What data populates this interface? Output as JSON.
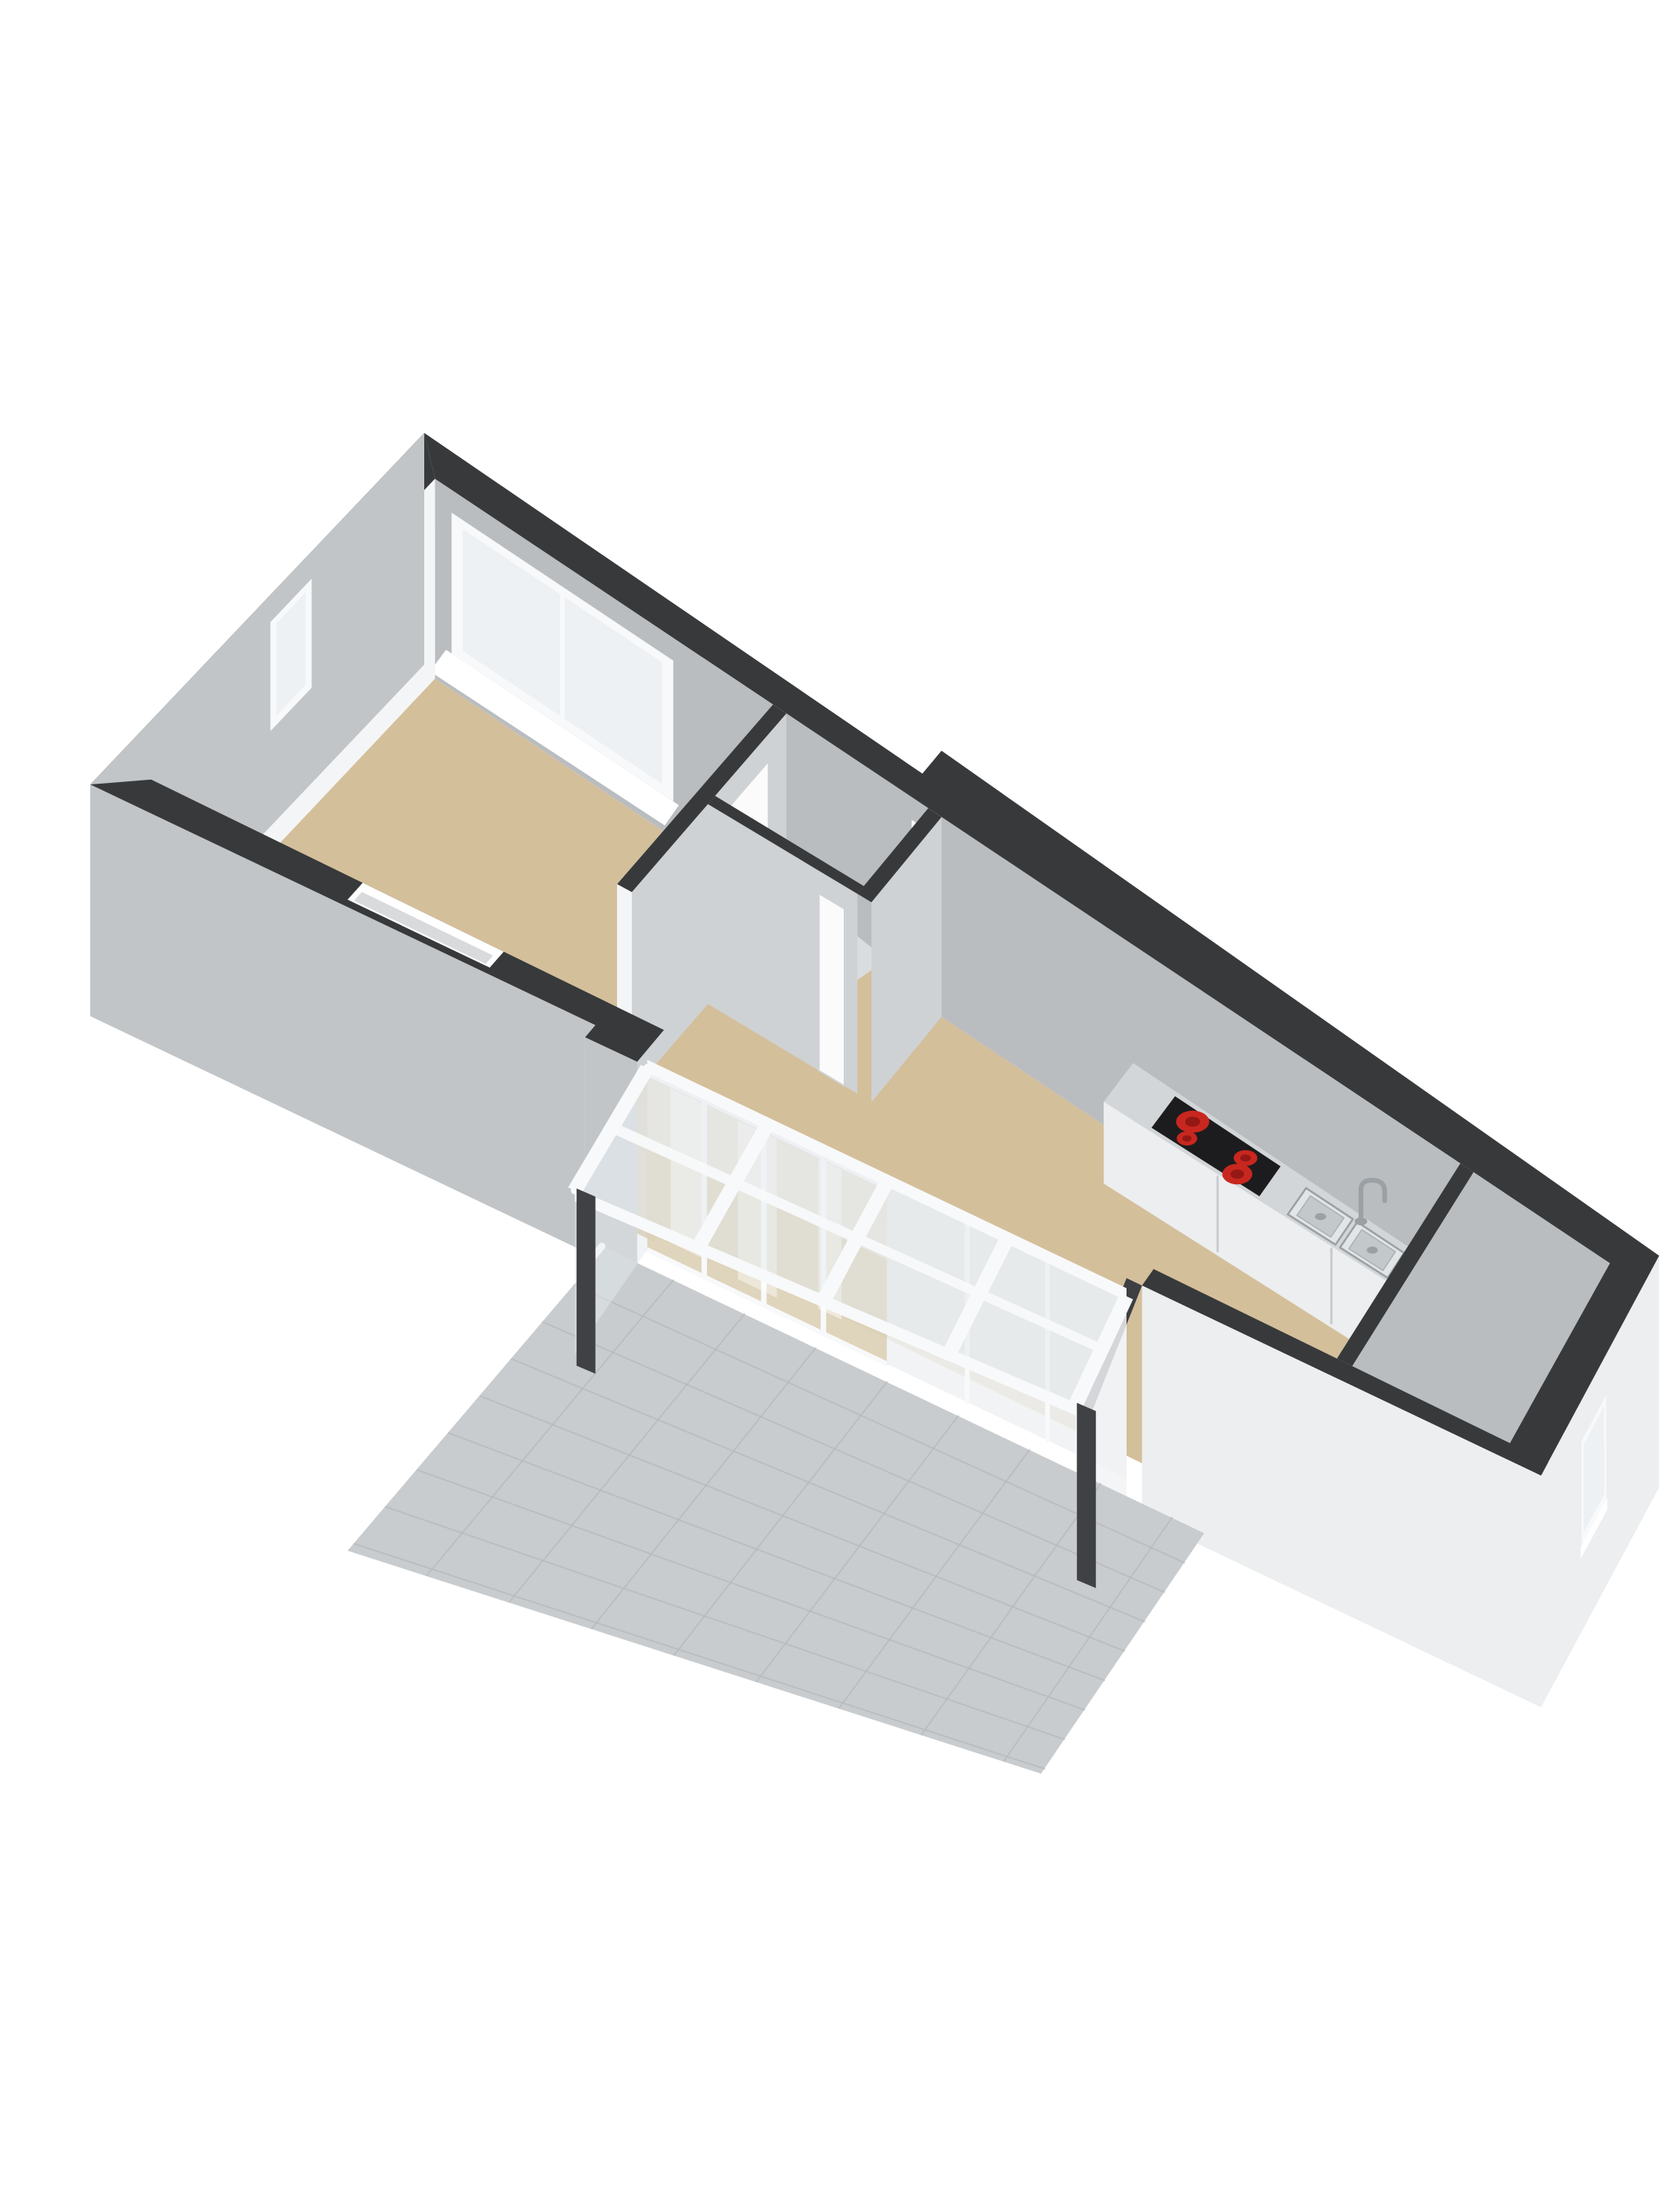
{
  "view": {
    "type": "floorplan-3d-isometric",
    "description": "3D dollhouse-style floor plan of a ground floor apartment, viewed from above at an angle, no text labels",
    "background": "#ffffff"
  },
  "colors": {
    "bg": "#ffffff",
    "wall_top": "#37393b",
    "wall_top_soft": "#3d3f42",
    "ext_gray": "#c2c5c7",
    "ext_gray_dark": "#b4b7ba",
    "ext_light": "#eceeef",
    "inner_white": "#f4f5f6",
    "inner_gray": "#b9bdc0",
    "inner_gray_lt": "#cfd2d4",
    "floor_tan": "#d4bf9b",
    "floor_tile": "#c9cccE",
    "tile_line": "#b6b9bb",
    "frame_white": "#f8f9fa",
    "glass_pale": "#eef1f3",
    "glass_roof": "#e4eaee",
    "glass_tan": "#ddd2b8",
    "door_white": "#fbfbfc",
    "handle_dark": "#6f7479",
    "cooktop_black": "#1c1c1e",
    "burner_red": "#c8271f",
    "burner_red_dark": "#8e1713",
    "steel_rim": "#e2e5e7",
    "steel_basin": "#c3c8cb",
    "steel_dark": "#9aa0a4",
    "post_dark": "#3f4144",
    "shadow_soft": "#e7e8e9"
  },
  "inventory": {
    "rooms": [
      {
        "name": "living-room",
        "floor": "tan"
      },
      {
        "name": "hallway",
        "floor": "tan"
      },
      {
        "name": "stair-closet",
        "feature": "winder-stairs"
      },
      {
        "name": "kitchen",
        "feature": "counter-along-north-wall"
      },
      {
        "name": "storage-room-east",
        "feature": "door-and-east-window"
      },
      {
        "name": "conservatory",
        "feature": "glass-roof-4-bays"
      },
      {
        "name": "patio",
        "floor": "gray-tiles"
      }
    ],
    "fixtures": {
      "cooktop_burners": 4,
      "sink_basins": 2,
      "faucet": 1,
      "conservatory_posts": 2,
      "roof_rafters": 5,
      "windows": [
        "north-big-window",
        "west-narrow-window",
        "east-window"
      ],
      "doors": [
        "living-room-door",
        "stair-closet-door",
        "entrance-door",
        "storage-room-door",
        "french-doors"
      ]
    }
  }
}
